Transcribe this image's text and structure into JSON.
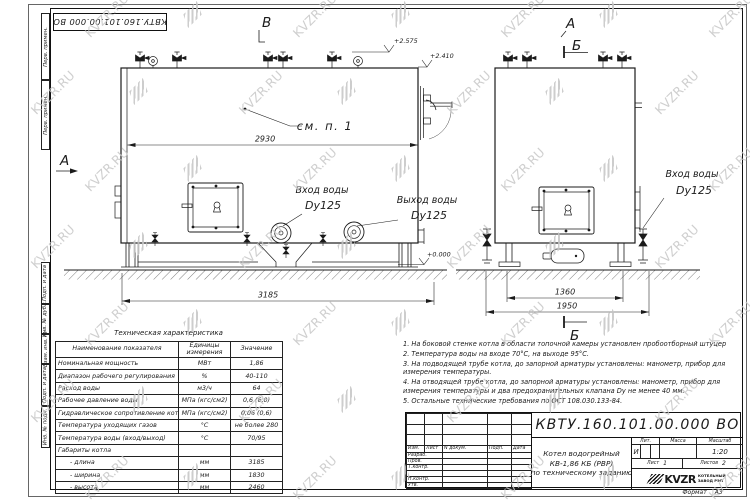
{
  "watermark": {
    "text": "KVZR.RU"
  },
  "stamp": {
    "doc_number": "КВТУ.160.101.00.000 ВО"
  },
  "side_strip": {
    "top": [
      "Перв. примен.",
      "Перв. примен."
    ],
    "bottom": [
      "Подп. и дата",
      "Инв. № дубл.",
      "Взам. инв. №",
      "Подп. и дата",
      "Инв. № подл."
    ]
  },
  "drawing": {
    "view_label_a": "А",
    "view_label_b": "Б",
    "view_label_v": "В",
    "see_note": "см. п. 1",
    "dim_2930": "2930",
    "dim_3185": "3185",
    "dim_1360": "1360",
    "dim_1950": "1950",
    "elev_top": "+2.575",
    "elev_step": "+2.410",
    "elev_zero": "+0.000",
    "inlet_line1": "Вход воды",
    "inlet_line2": "Dy125",
    "outlet_line1": "Выход воды",
    "outlet_line2": "Dy125"
  },
  "table": {
    "title": "Техническая характеристика",
    "headers": [
      "Наименование показателя",
      "Единицы измерения",
      "Значение"
    ],
    "rows": [
      [
        "Номинальная мощность",
        "МВт",
        "1,86"
      ],
      [
        "Диапазон рабочего регулирования",
        "%",
        "40-110"
      ],
      [
        "Расход воды",
        "м3/ч",
        "64"
      ],
      [
        "Рабочее давление воды",
        "МПа (кгс/см2)",
        "0,6 (6,0)"
      ],
      [
        "Гидравлическое сопротивление котла",
        "МПа (кгс/см2)",
        "0,06 (0,6)"
      ],
      [
        "Температура уходящих газов",
        "°С",
        "не более 280"
      ],
      [
        "Температура воды (вход/выход)",
        "°С",
        "70/95"
      ],
      [
        "Габариты котла",
        "",
        ""
      ],
      [
        "- длина",
        "мм",
        "3185"
      ],
      [
        "- ширина",
        "мм",
        "1830"
      ],
      [
        "- высота",
        "мм",
        "2460"
      ]
    ]
  },
  "notes": [
    "1.  На боковой стенке котла в области топочной камеры установлен пробоотборный штуцер",
    "2.  Температура воды на входе 70°С, на выходе 95°С.",
    "3.  На подводящей трубе котла, до запорной арматуры установлены: манометр, прибор для измерения температуры.",
    "4.  На отводящей трубе котла, до запорной арматуры установлены: манометр, прибор для измерения температуры и два предохранительных клапана Dу не менее 40 мм.",
    "5.  Остальные технические требования по ОСТ 108.030.133-84."
  ],
  "title_block": {
    "doc_number": "КВТУ.160.101.00.000  ВО",
    "rev_headers": [
      "Изм.",
      "Лист",
      "N докум.",
      "Подп.",
      "Дата"
    ],
    "sig_rows": [
      "Разраб.",
      "Пров.",
      "Т.контр.",
      "",
      "Н.контр.",
      "Утв."
    ],
    "name_line1": "Котел водогрейный",
    "name_line2": "КВ-1,86  КБ  (РВР)",
    "name_line3": "по техническому заданию",
    "lit_header": "Лит.",
    "mass_header": "Масса",
    "scale_header": "Масштаб",
    "lit_value": "И",
    "scale_value": "1:20",
    "sheet_label": "Лист",
    "sheet_value": "1",
    "sheets_label": "Листов",
    "sheets_value": "2",
    "logo_word": "KVZR",
    "company_line1": "КОТЕЛЬНЫЙ",
    "company_line2": "ЗАВОД РЭП",
    "format_label": "Формат",
    "format_value": "А3"
  }
}
